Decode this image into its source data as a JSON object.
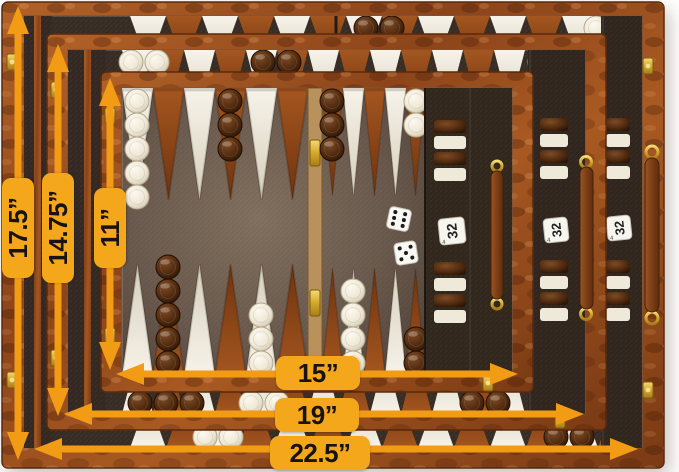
{
  "page": {
    "background": "#ffffff"
  },
  "palette": {
    "label_yellow": "#f5a71c",
    "arrow_orange": "#f29c15",
    "wood_burl": "#9a4f1f",
    "felt_dark": "#3a2f27",
    "felt_field": "#6f5f53",
    "point_white": "#efe9db",
    "point_rust": "#9c5120",
    "checker_white": "#f3eee1",
    "checker_brown": "#54300f",
    "brass": "#d9b23a",
    "leather_handle": "#8a4a22"
  },
  "callouts": {
    "vertical": [
      {
        "name": "large-height",
        "label": "17.5”"
      },
      {
        "name": "medium-height",
        "label": "14.75”"
      },
      {
        "name": "small-height",
        "label": "11”"
      }
    ],
    "horizontal": [
      {
        "name": "small-width",
        "label": "15”"
      },
      {
        "name": "medium-width",
        "label": "19”"
      },
      {
        "name": "large-width",
        "label": "22.5”"
      }
    ]
  },
  "boards": [
    {
      "size": "large",
      "width_label": "22.5”",
      "height_label": "17.5”"
    },
    {
      "size": "medium",
      "width_label": "19”",
      "height_label": "14.75”"
    },
    {
      "size": "small",
      "width_label": "15”",
      "height_label": "11”"
    }
  ],
  "doubling_cube": {
    "front_value": "32",
    "side_value": "4"
  },
  "dice": [
    {
      "pips": 6
    },
    {
      "pips": 5
    }
  ],
  "checker_colors": [
    "white",
    "brown"
  ]
}
